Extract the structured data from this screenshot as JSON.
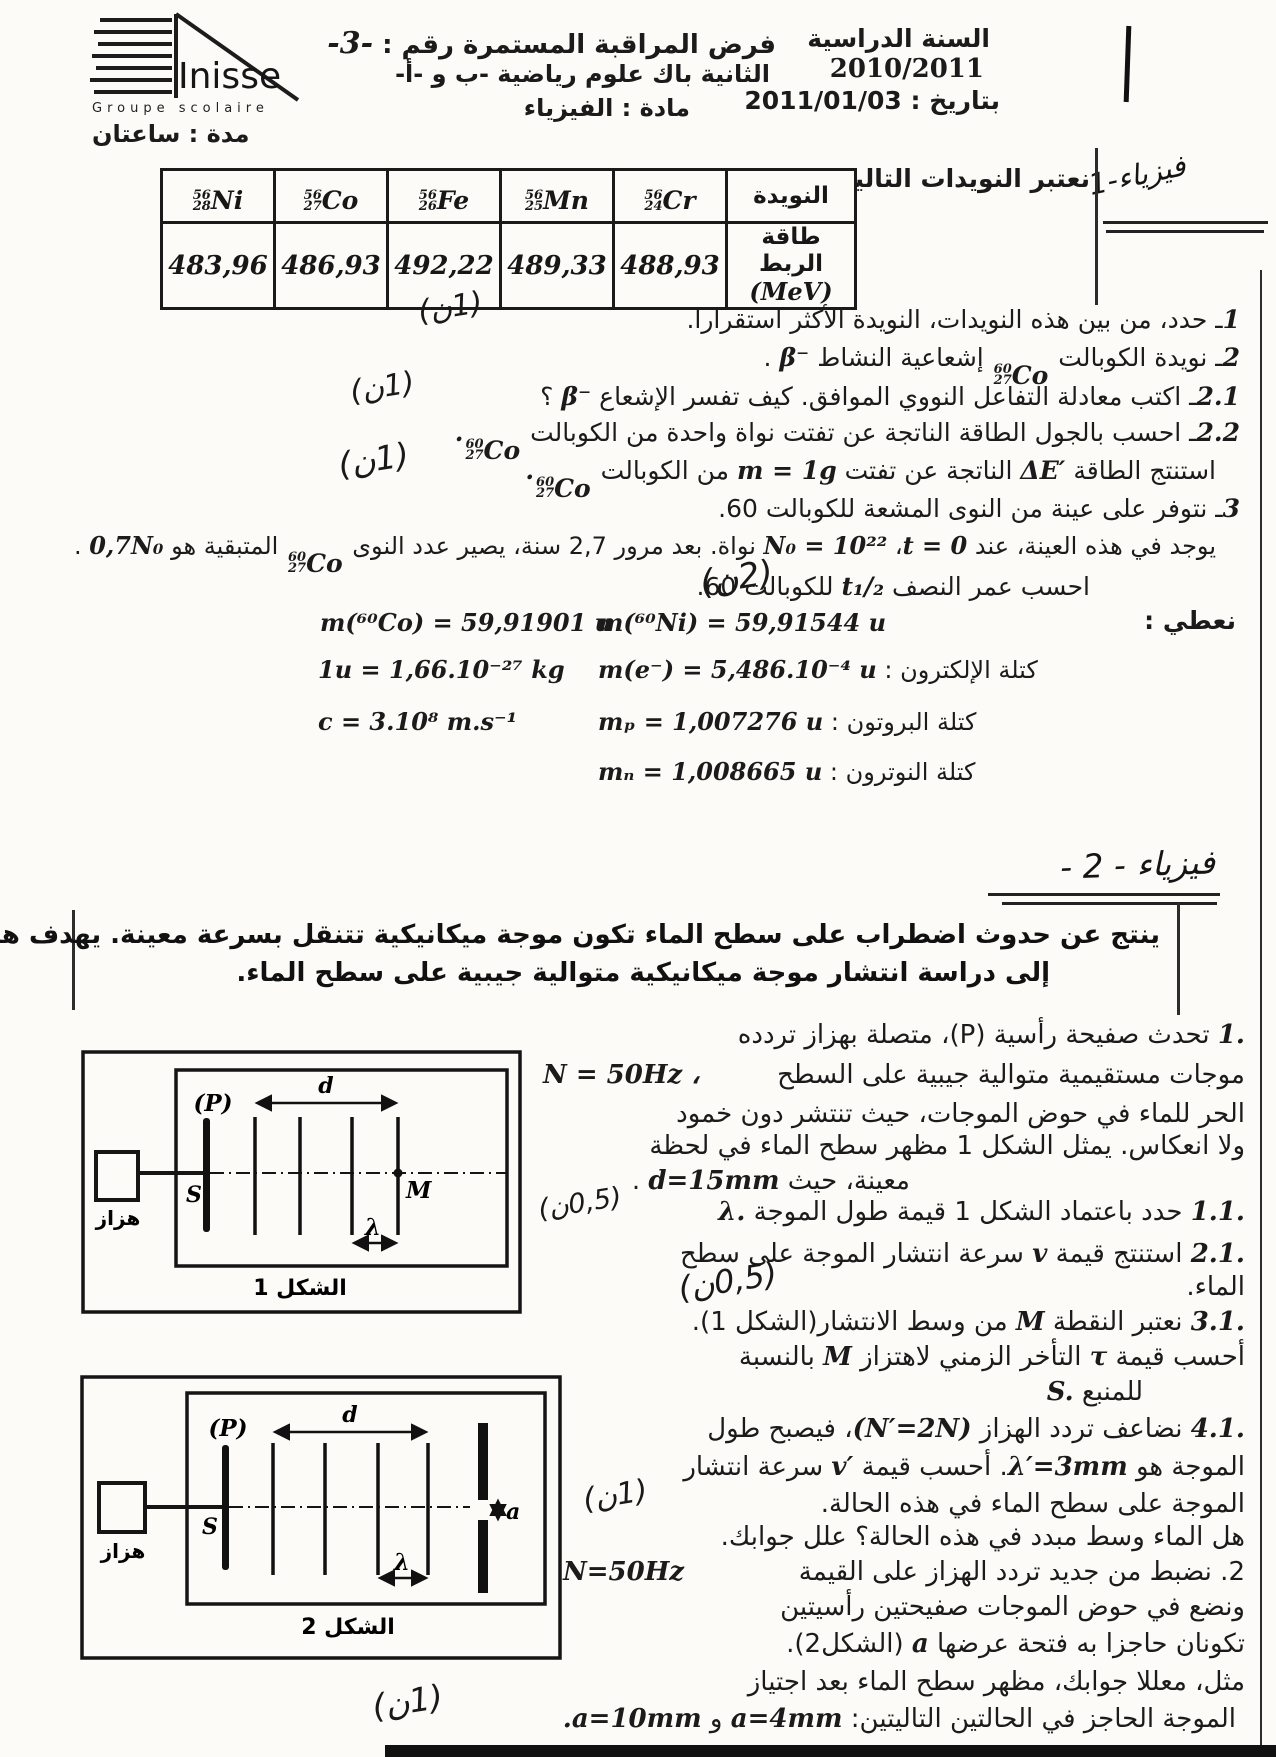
{
  "header": {
    "school_name": "Inisse",
    "school_sub": "Groupe scolaire",
    "duration": "مدة : ساعتان",
    "exam_title": "فرض المراقبة المستمرة رقم :",
    "exam_number": "-3-",
    "exam_level": "الثانية باك علوم رياضية -ب و -أ-",
    "exam_subject": "مادة : الفيزياء",
    "year_label": "السنة الدراسية",
    "year_value": "2010/2011",
    "date_line": "بتاريخ : 2011/01/03"
  },
  "physics1": {
    "margin_title": "فيزياء-1",
    "intro": "نعتبر النويدات التالية :",
    "table": {
      "nuclide_header": "النويدة",
      "energy_label": "طاقة الربط",
      "energy_unit": "(MeV)",
      "nuclides": [
        {
          "mass": "56",
          "z": "28",
          "sym": "Ni",
          "energy": "483,96"
        },
        {
          "mass": "56",
          "z": "27",
          "sym": "Co",
          "energy": "486,93"
        },
        {
          "mass": "56",
          "z": "26",
          "sym": "Fe",
          "energy": "492,22"
        },
        {
          "mass": "56",
          "z": "25",
          "sym": "Mn",
          "energy": "489,33"
        },
        {
          "mass": "56",
          "z": "24",
          "sym": "Cr",
          "energy": "488,93"
        }
      ]
    },
    "iso_co": {
      "mass": "60",
      "z": "27",
      "sym": "Co"
    },
    "q1": {
      "num": "1",
      "a1": "ـ حدد، من بين هذه النويدات، النويدة الأكثر استقرارا.",
      "mark": "(1ن)"
    },
    "q2": {
      "num": "2",
      "a1": "ـ نويدة الكوبالت ",
      "a2": " إشعاعية النشاط ",
      "m1": "β⁻",
      "a3": " ."
    },
    "q21": {
      "num": "2.1",
      "a1": "ـ اكتب معادلة التفاعل النووي الموافق. كيف تفسر الإشعاع ",
      "m1": "β⁻",
      "a2": " ؟",
      "mark": "(1ن)"
    },
    "q22": {
      "num": "2.2",
      "a1": "ـ احسب بالجول الطاقة الناتجة عن تفتت نواة واحدة من الكوبالت ",
      "m1": "."
    },
    "q22b": {
      "a1": "استنتج الطاقة ",
      "m1": "ΔE′",
      "a2": " الناتجة عن تفتت ",
      "m2": "m = 1g",
      "a3": " من الكوبالت ",
      "m3": " .",
      "mark": "(1ن)"
    },
    "q3": {
      "num": "3",
      "a1": "ـ نتوفر على عينة من النوى المشعة للكوبالت 60."
    },
    "q3b": {
      "a1": "يوجد في هذه العينة، عند ",
      "m1": "t = 0",
      "a2": "، ",
      "m2": "N₀ = 10²²",
      "a3": " نواة. بعد مرور 2,7 سنة، يصير عدد النوى ",
      "a4": " المتبقية هو ",
      "m3": "0,7N₀",
      "a5": " ."
    },
    "q3c": {
      "a1": "احسب عمر النصف ",
      "m1": "t₁/₂",
      "a2": " للكوبالت 60.",
      "mark": "(2ن)"
    },
    "given": {
      "label": "نعطي :",
      "ni": "m(⁶⁰Ni) = 59,91544 u",
      "co": "m(⁶⁰Co) = 59,91901 u",
      "electron_label": "كتلة الإلكترون : ",
      "electron": "m(e⁻) = 5,486.10⁻⁴ u",
      "u": "1u = 1,66.10⁻²⁷ kg",
      "proton_label": "كتلة البروتون : ",
      "proton": "mₚ = 1,007276 u",
      "c": "c = 3.10⁸ m.s⁻¹",
      "neutron_label": "كتلة النوترون : ",
      "neutron": "mₙ = 1,008665 u"
    }
  },
  "physics2": {
    "heading": "فيزياء - 2 -",
    "intro1": "ينتج عن حدوث اضطراب على سطح الماء تكون موجة ميكانيكية تتنقل بسرعة معينة. يهدف هذا التمرين",
    "intro2": "إلى دراسة انتشار موجة ميكانيكية متوالية جيبية على سطح الماء.",
    "l1": [
      "1.",
      " تحدث صفيحة رأسية (P)، متصلة بهزاز تردده"
    ],
    "l2": [
      "N = 50Hz ،",
      "موجات مستقيمية متوالية جيبية على السطح"
    ],
    "l3": [
      "الحر للماء في حوض الموجات، حيث تنتشر دون خمود"
    ],
    "l4": [
      "ولا انعكاس. يمثل الشكل 1 مظهر سطح الماء في لحظة"
    ],
    "l5": [
      "معينة، حيث ",
      "d=15mm",
      " ."
    ],
    "l6": [
      "1.1.",
      " حدد باعتماد الشكل 1 قيمة طول الموجة ",
      "λ."
    ],
    "l7": [
      "2.1.",
      " استنتج قيمة ",
      "v",
      " سرعة انتشار الموجة على سطح"
    ],
    "l8": [
      "الماء."
    ],
    "l9": [
      "3.1.",
      " نعتبر النقطة ",
      "M",
      " من وسط الانتشار(الشكل 1)."
    ],
    "l10": [
      "أحسب قيمة ",
      "τ",
      " التأخر الزمني لاهتزاز ",
      "M",
      " بالنسبة"
    ],
    "l11": [
      "للمنبع ",
      "S."
    ],
    "l12": [
      "4.1.",
      " نضاعف تردد الهزاز ",
      "(N′=2N)",
      "، فيصبح طول"
    ],
    "l13": [
      "الموجة هو ",
      "λ′=3mm",
      ". أحسب قيمة ",
      "v′",
      " سرعة انتشار"
    ],
    "l14": [
      "الموجة على سطح الماء في هذه الحالة."
    ],
    "l15": [
      "هل الماء وسط مبدد في هذه الحالة؟ علل جوابك."
    ],
    "l16": [
      "N=50Hz",
      "2. نضبط من جديد تردد الهزاز على القيمة"
    ],
    "l17": [
      "ونضع في حوض الموجات صفيحتين رأسيتين"
    ],
    "l18": [
      "تكونان حاجزا به فتحة عرضها ",
      "a",
      " (الشكل2)."
    ],
    "l19": [
      "مثل، معللا جوابك، مظهر سطح الماء بعد اجتياز"
    ],
    "l20": [
      "الموجة الحاجز في الحالتين التاليتين: ",
      "a=4mm",
      " و ",
      "a=10mm",
      "."
    ],
    "marks": {
      "m1": "(1ن)",
      "m6": "(0,5ن)",
      "m8": "(0,5ن)",
      "m14": "(1ن)",
      "m20": "(1ن)"
    }
  },
  "figures": {
    "fig1": {
      "caption": "الشكل 1",
      "vibrator": "هزاز",
      "plate": "(P)",
      "source": "S",
      "point": "M",
      "d": "d",
      "lambda": "λ"
    },
    "fig2": {
      "caption": "الشكل 2",
      "vibrator": "هزاز",
      "plate": "(P)",
      "source": "S",
      "d": "d",
      "lambda": "λ",
      "a": "a"
    }
  }
}
